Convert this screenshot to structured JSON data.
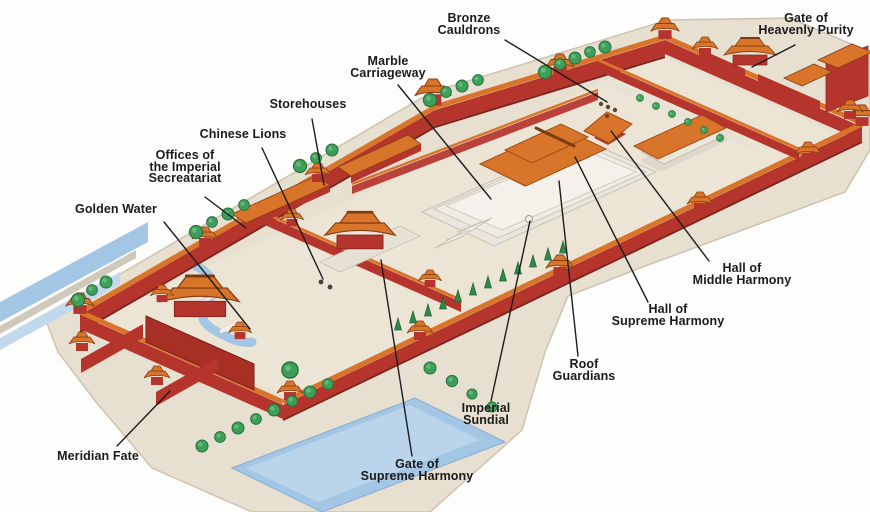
{
  "labels": {
    "bronze_cauldrons": {
      "line1": "Bronze",
      "line2": "Cauldrons"
    },
    "gate_of_heavenly_purity": {
      "line1": "Gate of",
      "line2": "Heavenly Purity"
    },
    "marble_carriageway": {
      "line1": "Marble",
      "line2": "Carriageway"
    },
    "storehouses": {
      "line1": "Storehouses"
    },
    "chinese_lions": {
      "line1": "Chinese Lions"
    },
    "offices_of_the_imperial_secretariat": {
      "line1": "Offices of",
      "line2": "the Imperial",
      "line3": "Secreatariat"
    },
    "golden_water": {
      "line1": "Golden Water"
    },
    "hall_of_middle_harmony": {
      "line1": "Hall of",
      "line2": "Middle Harmony"
    },
    "hall_of_supreme_harmony": {
      "line1": "Hall of",
      "line2": "Supreme Harmony"
    },
    "roof_guardians": {
      "line1": "Roof",
      "line2": "Guardians"
    },
    "imperial_sundial": {
      "line1": "Imperial",
      "line2": "Sundial"
    },
    "gate_of_supreme_harmony": {
      "line1": "Gate of",
      "line2": "Supreme Harmony"
    },
    "meridian_fate": {
      "line1": "Meridian Fate"
    }
  },
  "colors": {
    "bg_color": "#fdfdfb",
    "label_text": "#1b1b1b",
    "leader_line": "#1c1c1c",
    "roof_orange": "#d9742b",
    "wall_red": "#b5342c",
    "ground_beige": "#e7dfd0",
    "floor_beige": "#ece5d6",
    "marble_white": "#efece4",
    "water_blue": "#a3c6e4",
    "tree_green": "#3f9e58"
  }
}
